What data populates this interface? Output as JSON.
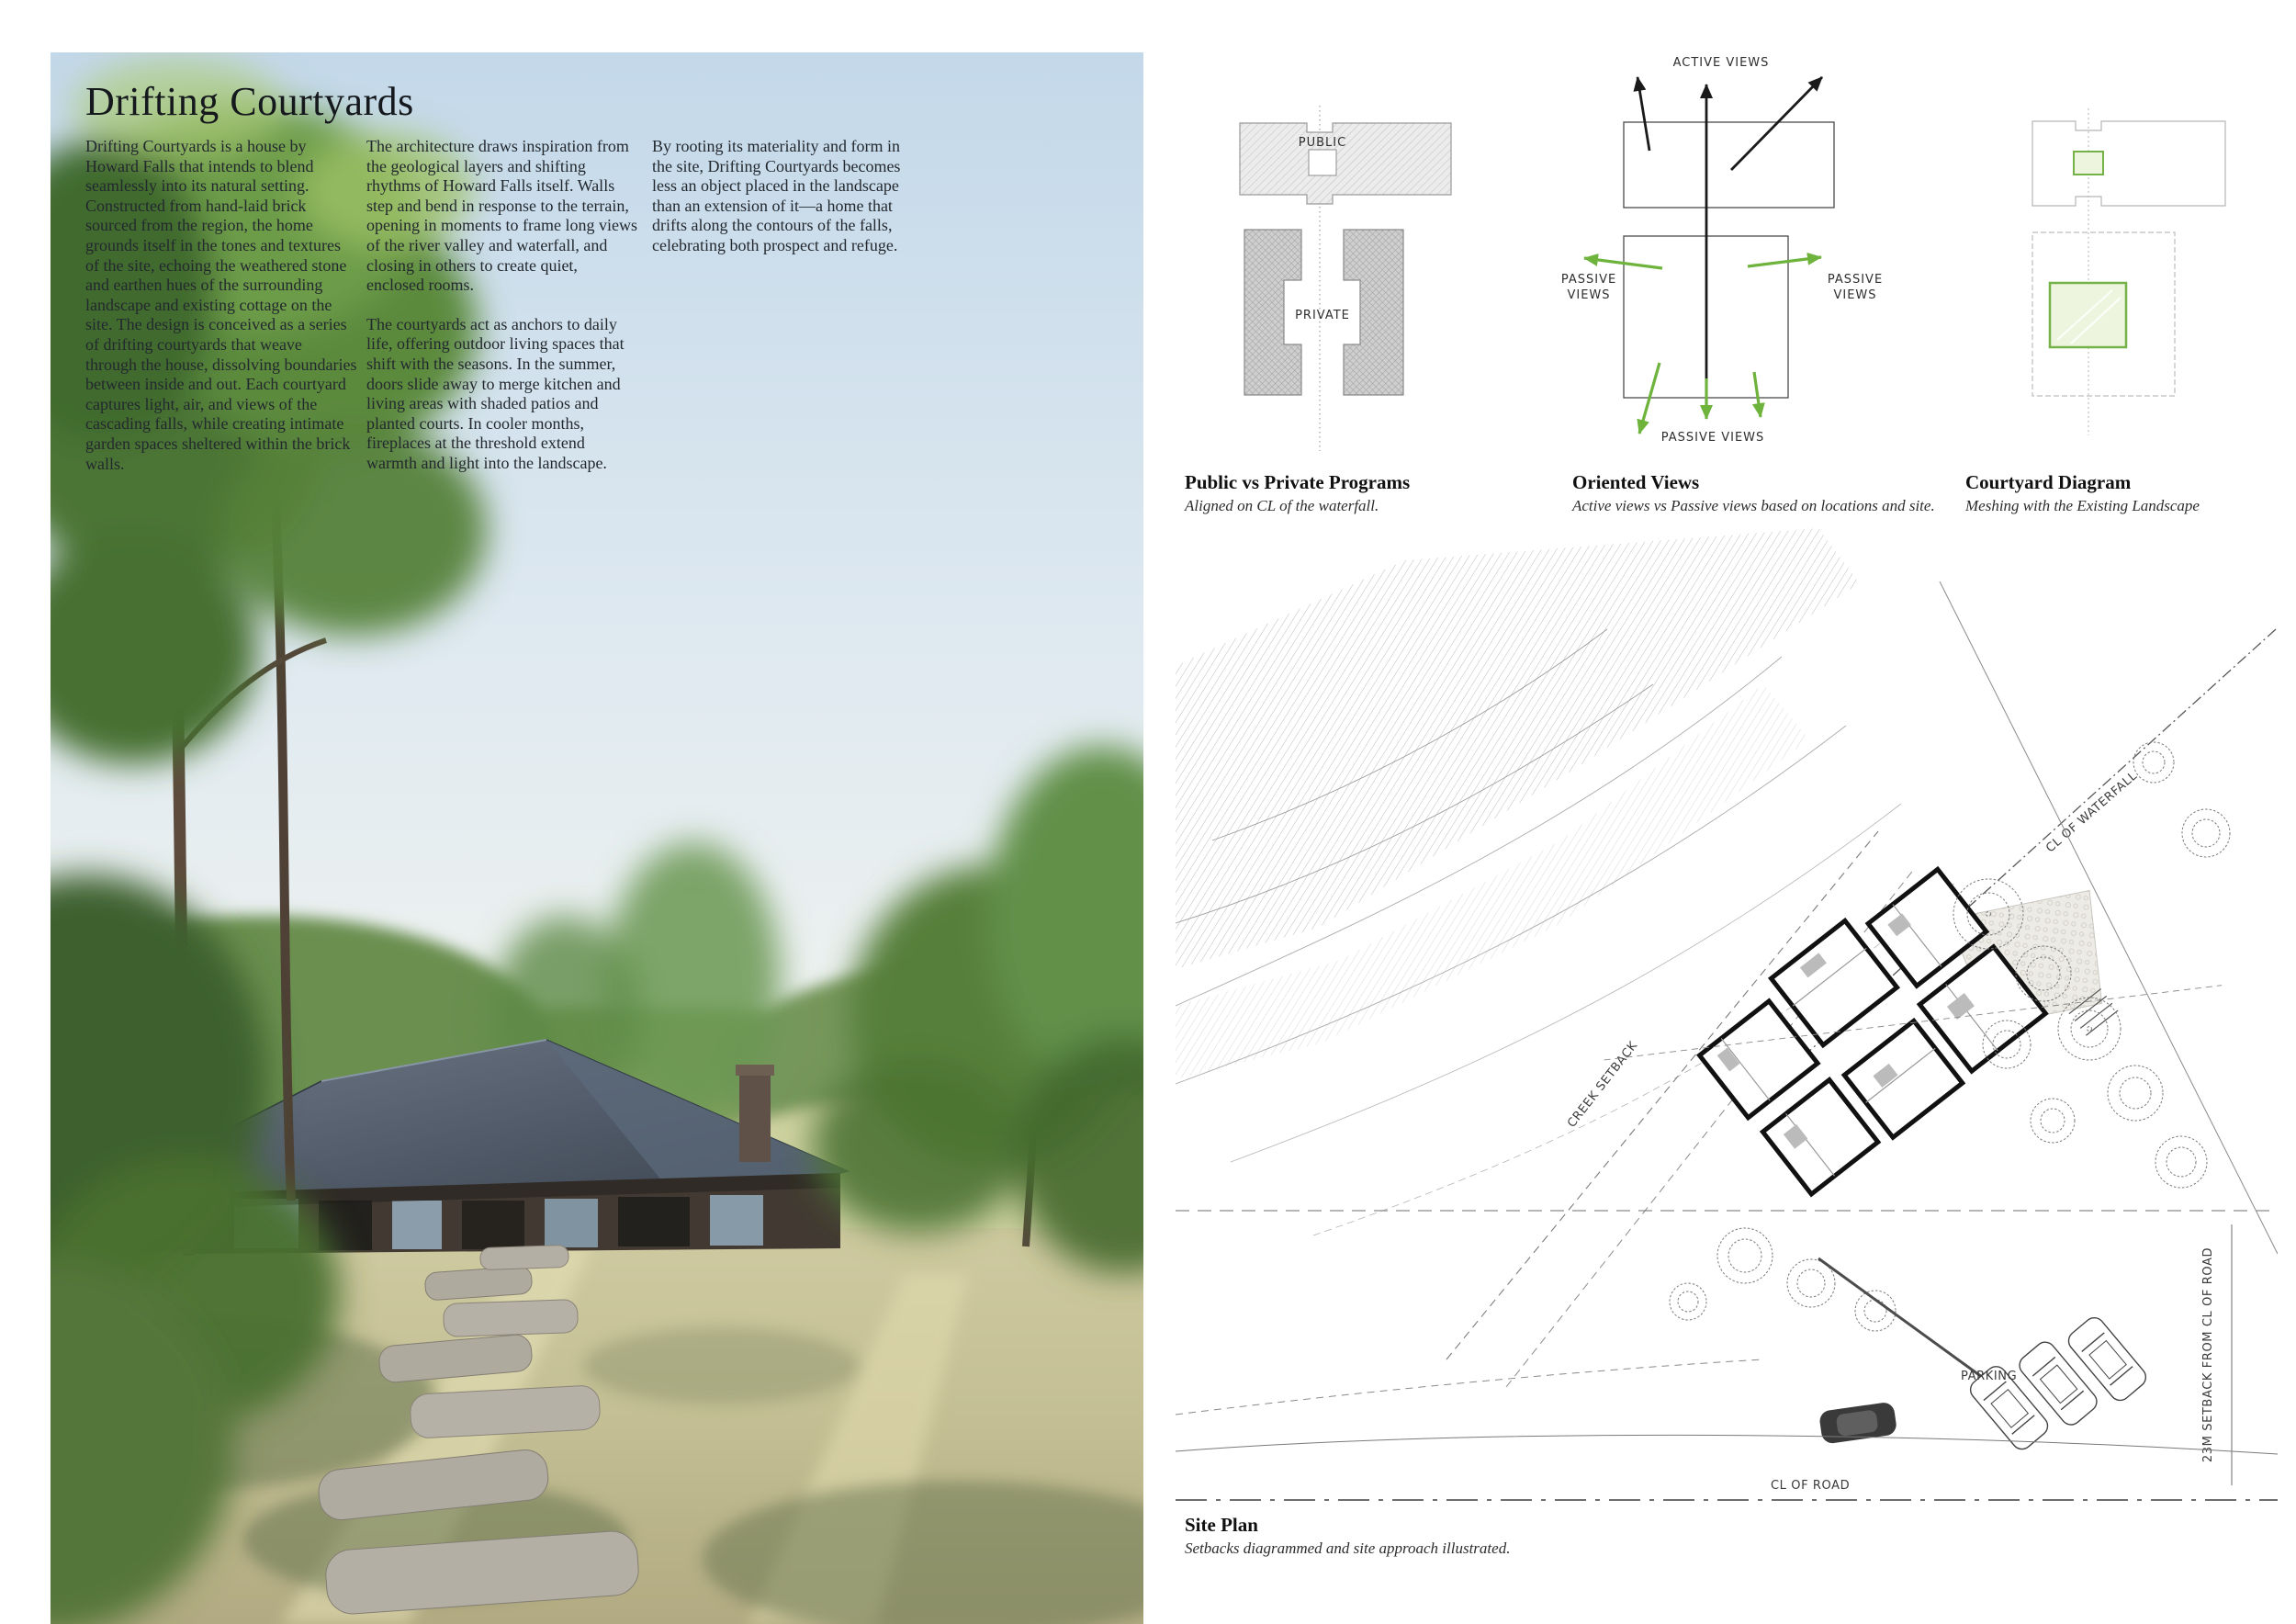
{
  "title": "Drifting Courtyards",
  "intro": {
    "col1": "Drifting Courtyards is a house by Howard Falls that intends to blend seamlessly into its natural setting. Constructed from hand-laid brick sourced from the region, the home grounds itself in the tones and textures of the site, echoing the weathered stone and earthen hues of the surrounding landscape and existing cottage on the site. The design is conceived as a series of drifting courtyards that weave through the house, dissolving boundaries between inside and out. Each courtyard captures light, air, and views of the cascading falls, while creating intimate garden spaces sheltered within the brick walls.",
    "col2_p1": "The architecture draws inspiration from the geological layers and shifting rhythms of Howard Falls itself. Walls step and bend in response to the terrain, opening in moments to frame long views of the river valley and waterfall, and closing in others to create quiet, enclosed rooms.",
    "col2_p2": "The courtyards act as anchors to daily life, offering outdoor living spaces that shift with the seasons. In the summer, doors slide away to merge kitchen and living areas with shaded patios and planted courts. In cooler months, fireplaces at the threshold extend warmth and light into the landscape.",
    "col3": "By rooting its materiality and form in the site, Drifting Courtyards becomes less an object placed in the landscape than an extension of it—a home that drifts along the contours of the falls, celebrating both prospect and refuge."
  },
  "diagrams": [
    {
      "title": "Public vs Private Programs",
      "subtitle": "Aligned on CL of the waterfall.",
      "labels": {
        "public": "PUBLIC",
        "private": "PRIVATE"
      }
    },
    {
      "title": "Oriented Views",
      "subtitle": "Active views vs Passive views based on locations and site.",
      "labels": {
        "active": "ACTIVE VIEWS",
        "passive_line1": "PASSIVE",
        "passive_line2": "VIEWS",
        "passive_bottom": "PASSIVE VIEWS"
      }
    },
    {
      "title": "Courtyard Diagram",
      "subtitle": "Meshing with the Existing Landscape"
    }
  ],
  "site_plan": {
    "title": "Site Plan",
    "subtitle": "Setbacks diagrammed and site approach illustrated.",
    "labels": {
      "waterfall": "CL OF WATERFALL",
      "creek_setback": "CREEK SETBACK",
      "parking": "PARKING",
      "road": "CL OF ROAD",
      "road_setback": "23M SETBACK FROM CL OF ROAD"
    }
  },
  "colors": {
    "accent_green": "#6db33c",
    "hatch_gray": "#bdbdbd",
    "ink": "#1f2328"
  }
}
